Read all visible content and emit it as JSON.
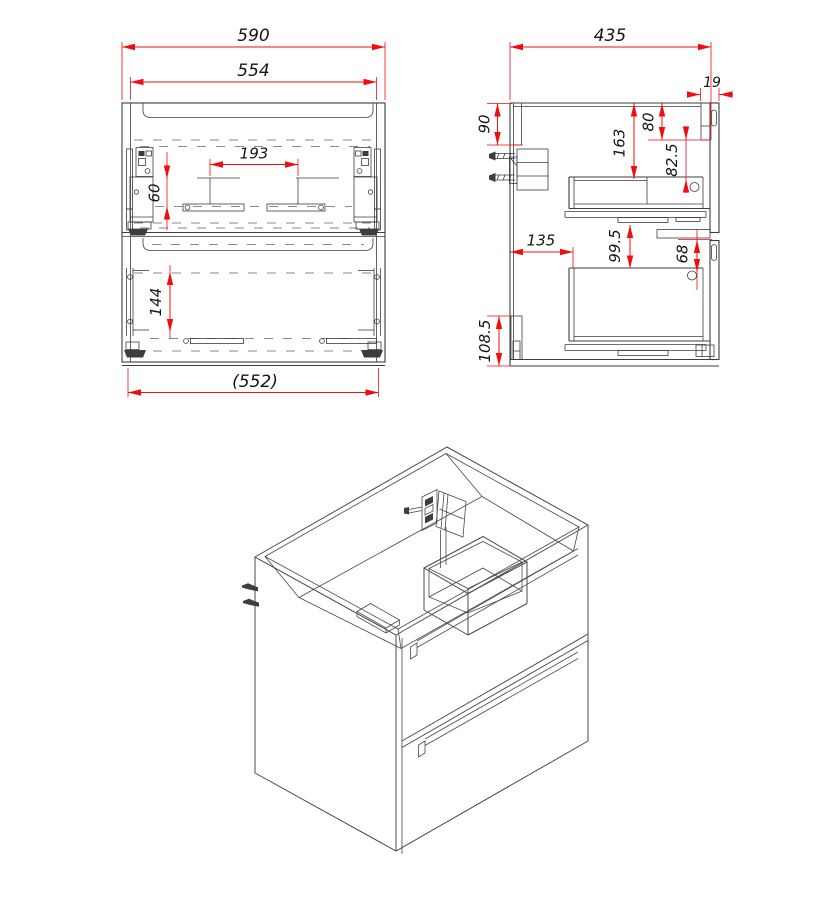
{
  "sheet": {
    "background": "#ffffff"
  },
  "colors": {
    "line": "#3d3d3d",
    "iso": "#4a4a4a",
    "dim": "#ef0d0d",
    "text": "#141414"
  },
  "views": {
    "front": {
      "title": "front-view",
      "dims": {
        "overall_width": "590",
        "groove_width": "554",
        "center_bracket_span": "193",
        "upper_bracket_height": "60",
        "lower_bracket_height": "144",
        "internal_width": "(552)"
      }
    },
    "side": {
      "title": "side-view",
      "dims": {
        "overall_depth": "435",
        "front_panel_thickness": "19",
        "back_rail_height": "90",
        "top_to_drawer_body": "163",
        "front_rail_height": "80",
        "rail_to_hole": "82.5",
        "back_to_drawer_front": "135",
        "drawer_gap": "99.5",
        "hole_offset": "68",
        "bottom_bracket_height": "108.5"
      }
    },
    "iso": {
      "title": "isometric-view"
    }
  }
}
